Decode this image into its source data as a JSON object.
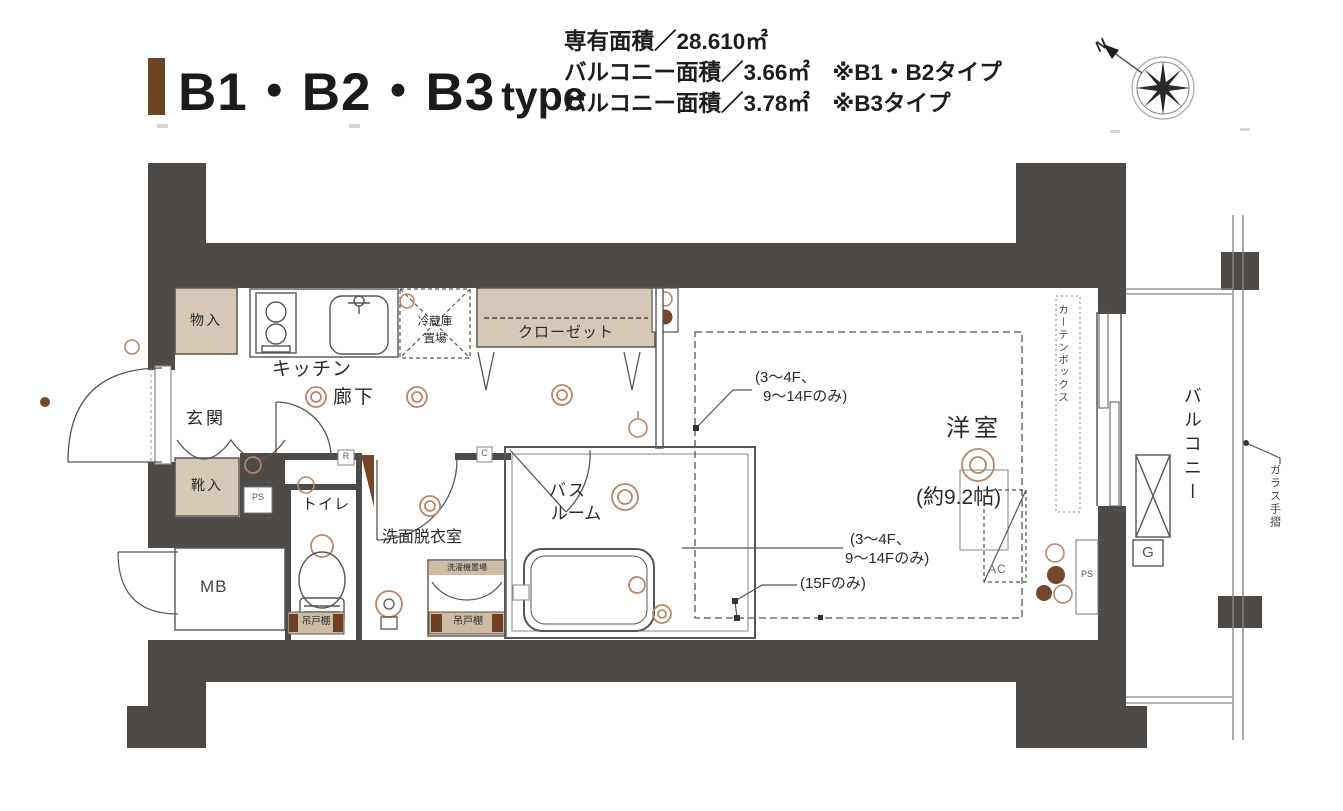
{
  "header": {
    "accent_color": "#6a4527",
    "title": "B1・B2・B3",
    "title_suffix": "type",
    "specs": [
      "専有面積／28.610㎡",
      "バルコニー面積／3.66㎡　※B1・B2タイプ",
      "バルコニー面積／3.78㎡　※B3タイプ"
    ],
    "compass_north": "N"
  },
  "plan": {
    "labels": {
      "mono_ire": "物入",
      "genkan": "玄関",
      "kutsu_ire": "靴入",
      "kitchen": "キッチン",
      "rouka": "廊下",
      "reizouko_l1": "冷蔵庫",
      "reizouko_l2": "置場",
      "closet": "クローゼット",
      "toilet": "トイレ",
      "senmen": "洗面脱衣室",
      "bath_l1": "バス",
      "bath_l2": "ルーム",
      "washer": "洗濯機置場",
      "cupboard_toilet": "吊戸棚",
      "cupboard_washer": "吊戸棚",
      "youshitsu": "洋室",
      "youshitsu_size": "(約9.2帖)",
      "mb": "MB",
      "ps_left": "PS",
      "ps_right": "PS",
      "ac": "AC",
      "g": "G",
      "r": "R",
      "c": "C",
      "curtain_box": "カーテンボックス",
      "balcony": "バルコニー",
      "glass_rail": "ガラス手摺"
    },
    "annotations": {
      "a1a": "(3〜4F、",
      "a1b": "9〜14Fのみ)",
      "a2a": "(3〜4F、",
      "a2b": "9〜14Fのみ)",
      "a3": "(15Fのみ)"
    },
    "colors": {
      "wall": "#4e4a48",
      "beige": "#d5c8b6",
      "band": "#cdbba4",
      "tan": "#b5886a",
      "brown": "#74472a",
      "line": "#595551"
    }
  }
}
